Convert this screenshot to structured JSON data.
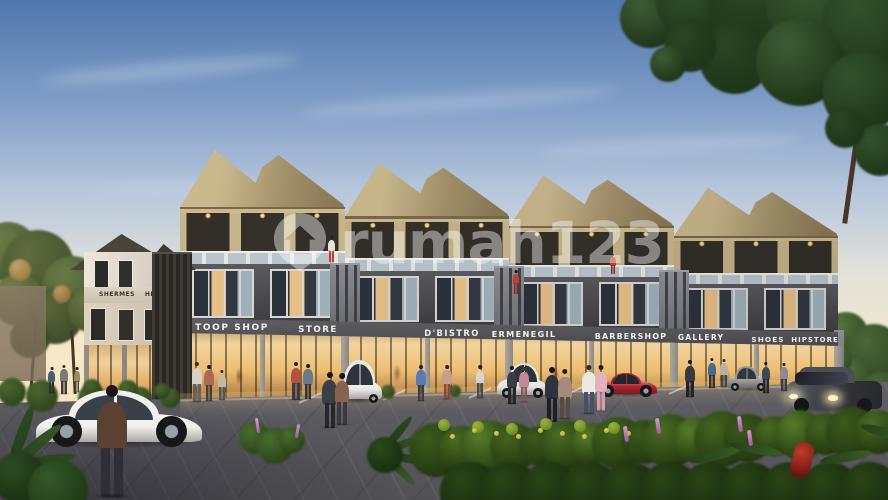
{
  "scene": {
    "type": "architectural-exterior-render",
    "setting": "Modern three-story shophouse row at dusk with lit retail storefronts, plaza parking, pedestrians and tropical landscaping",
    "watermark": {
      "text": "rumah123",
      "icon": "location-pin-house",
      "color": "#ffffff",
      "opacity": 0.42
    }
  },
  "buildings": {
    "left_annex": {
      "signs": [
        "SHERMES",
        "HERME"
      ]
    },
    "shophouse_row": {
      "floors": 3,
      "units": 4,
      "shop_signs": [
        "TOOP SHOP",
        "STORE",
        "D'BISTRO",
        "ERMENEGIL",
        "BARBERSHOP",
        "GALLERY",
        "SHOES",
        "HIPSTORE"
      ]
    }
  },
  "vehicles": [
    {
      "kind": "sedan",
      "color": "white"
    },
    {
      "kind": "minivan",
      "color": "white"
    },
    {
      "kind": "suv",
      "color": "white"
    },
    {
      "kind": "sports-car",
      "color": "red"
    },
    {
      "kind": "hatchback",
      "color": "silver"
    },
    {
      "kind": "sedan",
      "color": "dark-gray",
      "headlights": "on"
    }
  ],
  "palette": {
    "sky_top": "#4f77ac",
    "sky_horizon": "#f4e3bd",
    "roof_tan": "#c0ae83",
    "facade_dark": "#46454a",
    "sign_band": "#4e4e53",
    "storefront_glow": "#eab668",
    "paving": "#7e7d82",
    "foliage": "#3c5a24",
    "accent_red_car": "#b02430"
  }
}
